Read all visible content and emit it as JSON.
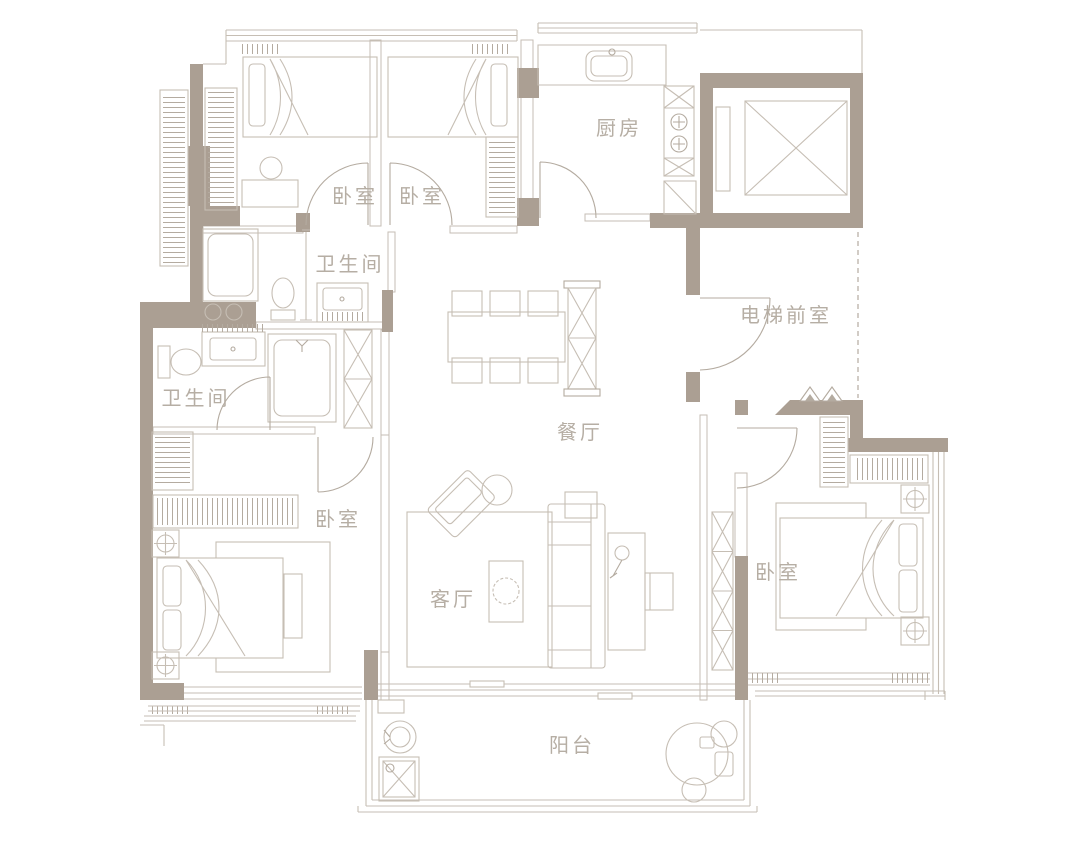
{
  "document": {
    "type": "apartment-floor-plan"
  },
  "colors": {
    "wall": "#ab9f93",
    "line": "#c6beb4",
    "line_strong": "#b4aba0",
    "label": "#b6aea4",
    "background": "#ffffff"
  },
  "rooms": {
    "bedroom_top_left": {
      "label": "卧室"
    },
    "bedroom_top_right": {
      "label": "卧室"
    },
    "kitchen": {
      "label": "厨房"
    },
    "bathroom_upper": {
      "label": "卫生间"
    },
    "bathroom_lower": {
      "label": "卫生间"
    },
    "elevator_lobby": {
      "label": "电梯前室"
    },
    "dining_room": {
      "label": "餐厅"
    },
    "bedroom_left": {
      "label": "卧室"
    },
    "bedroom_right": {
      "label": "卧室"
    },
    "living_room": {
      "label": "客厅"
    },
    "balcony": {
      "label": "阳台"
    }
  }
}
